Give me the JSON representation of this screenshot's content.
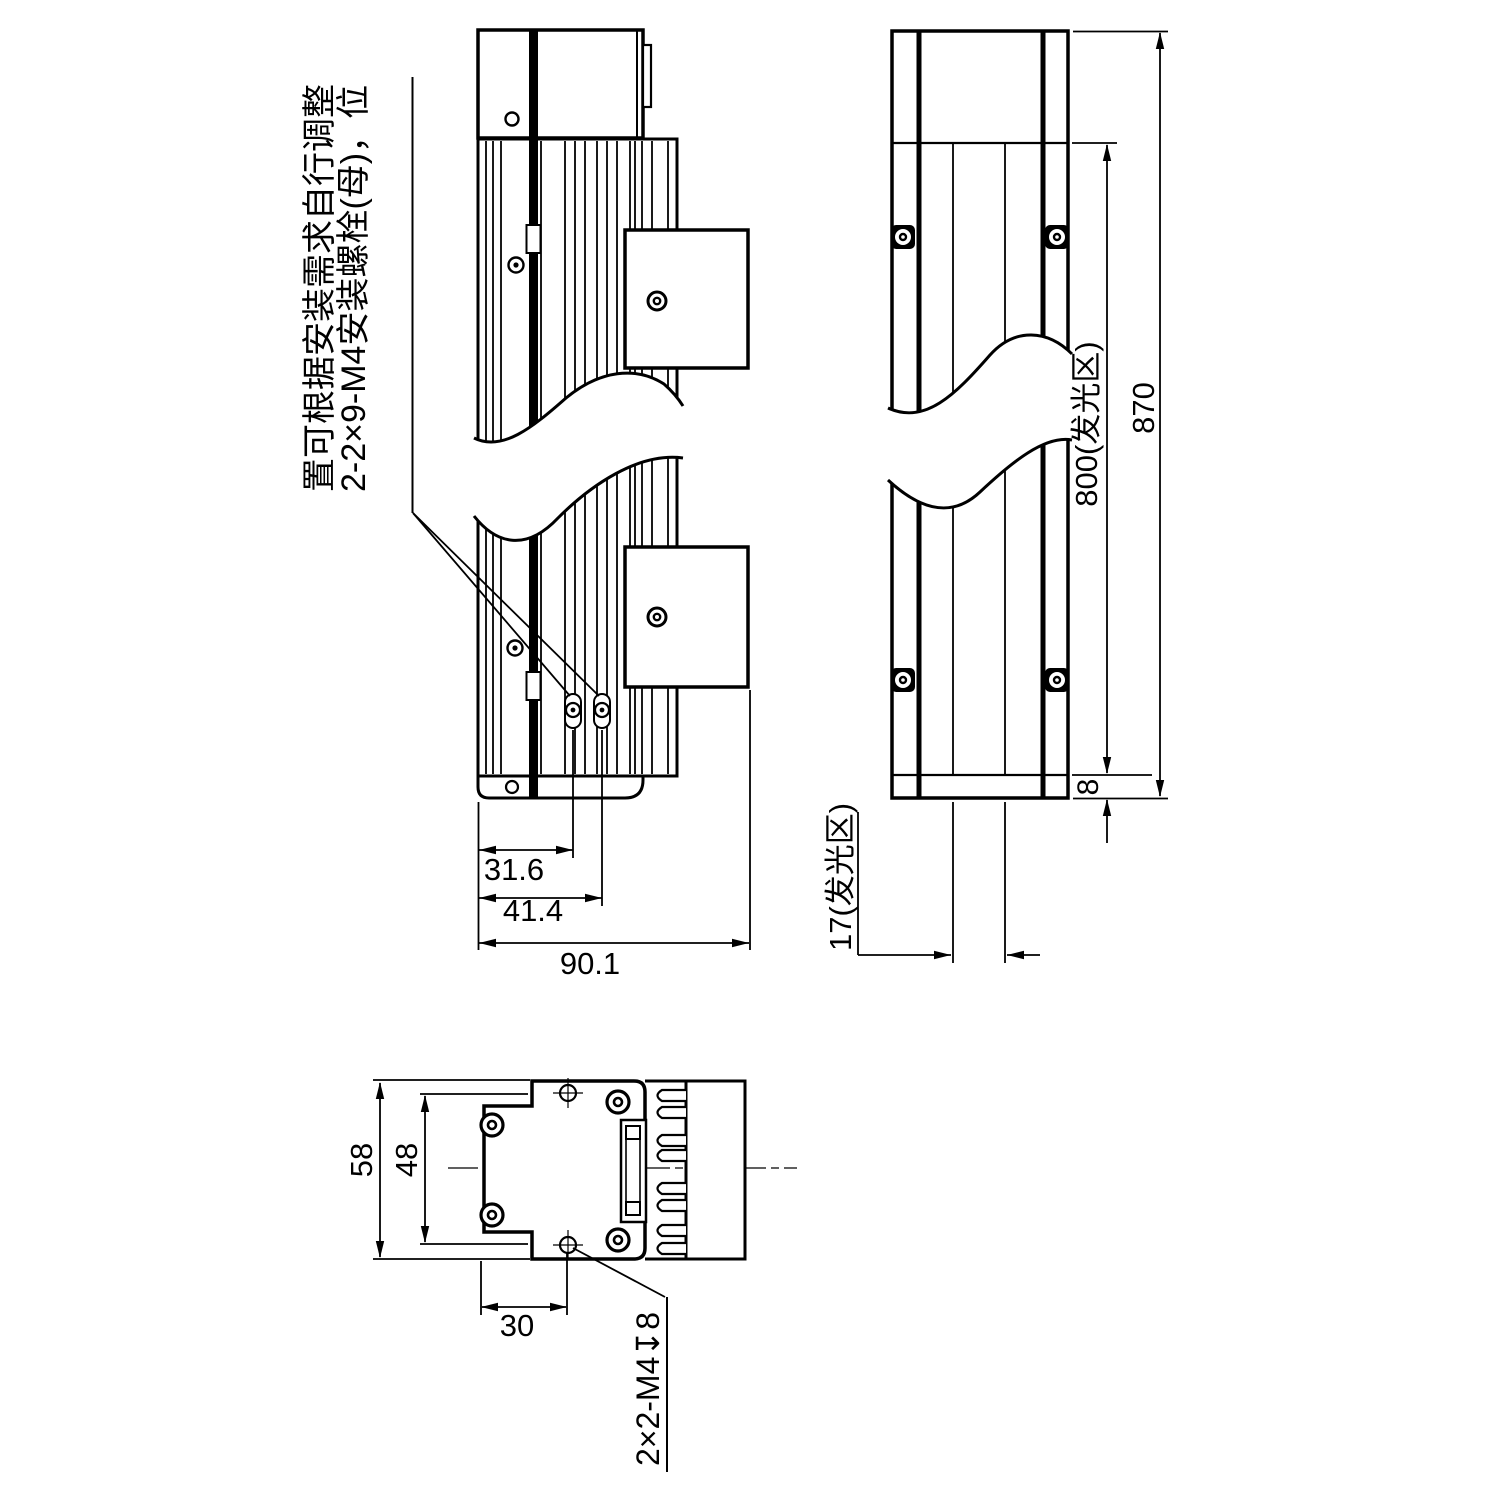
{
  "colors": {
    "ink": "#000000",
    "background": "#ffffff"
  },
  "note": {
    "col_left": "置可根据安装需求自行调整",
    "col_right": "2-2×9-M4安装螺栓(母)，位"
  },
  "front_view": {
    "dim_31_6": "31.6",
    "dim_41_4": "41.4",
    "dim_90_1": "90.1"
  },
  "side_view": {
    "dim_870": "870",
    "dim_800": "800(发光区)",
    "dim_8": "8",
    "dim_17": "17(发光区)"
  },
  "end_view": {
    "dim_58": "58",
    "dim_48": "48",
    "dim_30": "30",
    "thread_callout": "2×2-M4↧8"
  }
}
